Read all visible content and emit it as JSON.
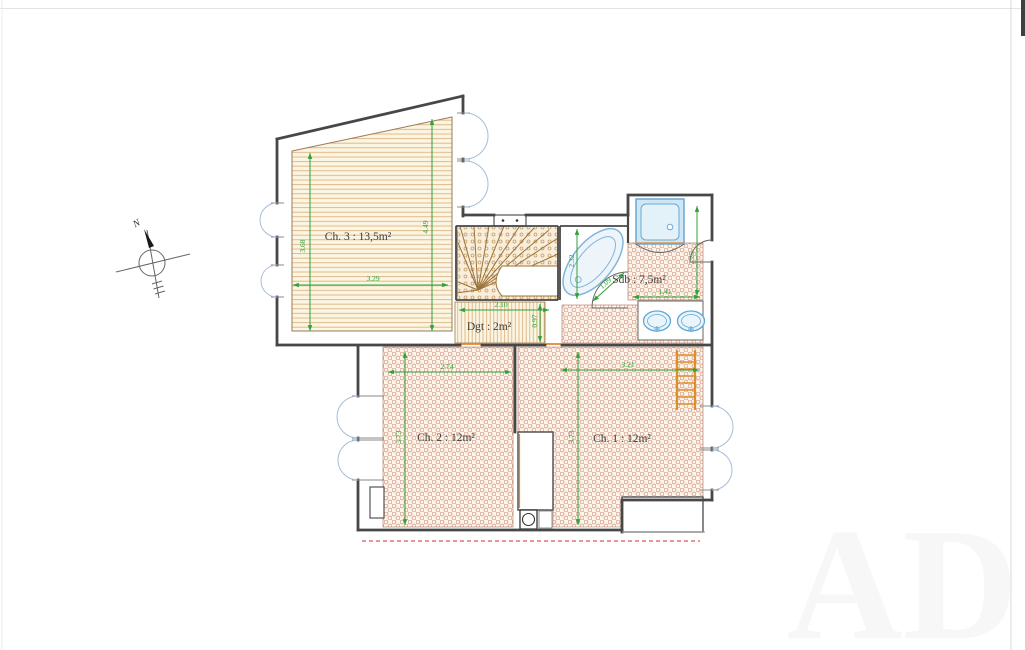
{
  "title": "Floor plan - upper level",
  "compass": {
    "north": "N"
  },
  "rooms": {
    "ch3": {
      "label": "Ch. 3 : 13,5m²"
    },
    "ch2": {
      "label": "Ch. 2 : 12m²"
    },
    "ch1": {
      "label": "Ch. 1 : 12m²"
    },
    "sdb": {
      "label": "Sdb : 7,5m²"
    },
    "dgt": {
      "label": "Dgt : 2m²"
    }
  },
  "dimensions": {
    "ch3_left": "3.68",
    "ch3_right": "4.49",
    "ch3_width": "3.29",
    "dgt_width": "2.10",
    "dgt_depth": "0.97",
    "bath_length": "2.32",
    "bath_door": "1.09",
    "sdb_height": "2.25",
    "sdb_vanity": "1.41",
    "ch2_width": "2.74",
    "ch2_depth": "3.73",
    "ch1_width": "3.21",
    "ch1_depth": "3.73"
  },
  "watermark": "AD",
  "colors": {
    "dimension_green": "#2fa136",
    "wall": "#474747",
    "tile_red": "#d99c88",
    "wood_tan": "#d8ad7c",
    "fixture_blue": "#6fa9d2",
    "window_blue": "#a6bddb",
    "roof_dashed_red": "#e25555",
    "threshold_orange": "#e08a2e"
  }
}
